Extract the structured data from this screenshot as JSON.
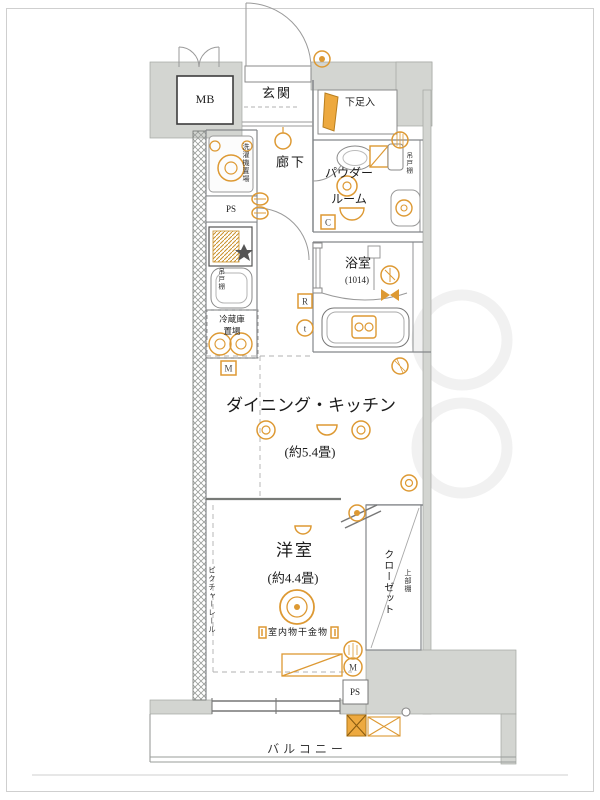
{
  "labels": {
    "mb": "MB",
    "genkan": "玄関",
    "shoe_box": "下足入",
    "hallway": "廊下",
    "powder_room_line1": "パウダー",
    "powder_room_line2": "ルーム",
    "bathroom": "浴室",
    "bathroom_size": "(1014)",
    "dining_kitchen": "ダイニング・キッチン",
    "dining_kitchen_size": "(約5.4畳)",
    "western_room": "洋室",
    "western_room_size": "(約4.4畳)",
    "closet": "クローゼット",
    "upper_shelf": "上部棚",
    "picture_rail": "ピクチャーレール",
    "indoor_drying": "室内物干金物",
    "washer_space": "洗濯機置場",
    "fridge_line1": "冷蔵庫",
    "fridge_line2": "置場",
    "hanging_cupboard": "吊戸棚",
    "ps": "PS",
    "balcony": "バルコニー"
  },
  "icon_letters": {
    "meter_box": "M",
    "c_box": "C",
    "r_box": "R",
    "t_circle": "t",
    "m_circle": "M"
  },
  "colors": {
    "accent": "#DD9933",
    "wall_gray": "#D3D5D1",
    "line_gray": "#84878A"
  }
}
